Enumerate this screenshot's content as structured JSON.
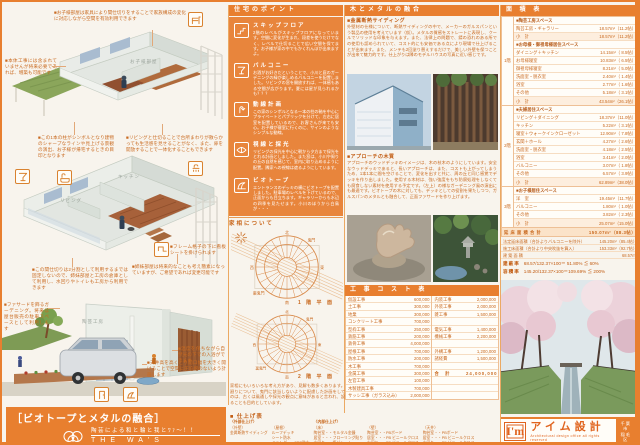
{
  "colors": {
    "accent": "#e87f2f",
    "accent_deep": "#c25c12",
    "panel_orange": "#e8853c",
    "text_orange": "#c96a20"
  },
  "left": {
    "labels": {
      "r1_room": "お子様部屋",
      "r2_living": "リビング",
      "r2_kitchen": "キッチン",
      "r3_studio": "陶芸工房"
    },
    "annotations": [
      "■お子様部屋は家具により間仕切りをすることで家族構成の変化に対応しながら空間を有効利用できます",
      "■本体工事には含まれていませんが将来必要であれば、増築も可能です",
      "■この1本の柱がシンボルとなり建物のシャープなラインや見上げる景観の演出、お子様が帰宅するときの目印となります",
      "■リビングと仕切ることで台所まわりが散らかっても生活感を見せることがなく、また、扉を開放することで一体化することもできます",
      "■フレーム格子の下に看板シートを掛けられます",
      "■この間仕切りは2分割として利用するまでは固定しないので、姉妹部屋と工房の倉庫として利用し、水回りやトイレも工房から利用できます",
      "■姉妹部屋は将来的なことも考え簡素になっていますが、ご希望であれば変更可能です",
      "■ファサードを飾るガーデニング。将来は屋台販売の駐車スペースとして利用します",
      "■温度を保ちながら自然光の下での入浴ができます",
      "■天井高を高くとり開口幅を大きく開けることで空間に圧迫感のないよう計画します"
    ],
    "banner": {
      "title": "［ビオトープとメタルの融合］",
      "tagline": "陶芸による和と輪と我とﾜｧ～！！",
      "subtitle": "THE WA'S HOUSE"
    }
  },
  "points": {
    "header": "住宅のポイント",
    "sections": [
      {
        "icon": "skip-floor-icon",
        "title": "スキップフロア",
        "body": "2階のレベルがスキップフロアになっています。空間に変化が生まれ、段差を使うだけでなく、レベルで仕切ることで広い空間を保てます。お子様が家の中でもかくれんぼが出来ますよ。"
      },
      {
        "icon": "cocktail-icon",
        "title": "バルコニー",
        "body": "お酒がお好きだということで、小川と庭のガーデニングの緑が楽しめるバルコニーを配置しました。リビングの窓を開放すれば、一体感もある空間が広がります。夏には星が見られるかも？？？"
      },
      {
        "icon": "flow-line-icon",
        "title": "動線計画",
        "body": "この家のシンボルとなる一本の柱の軸を中心にプライベートとパブリックを分けて、左右に居室を配置しているので、お客さんが来ても安心。お子様が寝室に行くのに、サインのようなシンプルな動線。"
      },
      {
        "icon": "daylight-icon",
        "title": "視線と採光",
        "body": "リビングの採光を中心に朝から夕方まで採光をとれる計画としました。また窓は、小川や周りの丘の自然を感じて、室内に取り込めるように配置。隣家への視線は遮るようにしています。"
      },
      {
        "icon": "biotope-icon",
        "title": "ビオトープ",
        "body": "エントランスのデッキの横にビオトープを配置しました。駐車場のレベルを下げているので、正面からも目立ちます。ギャラリーからも水辺の四季を見たせます。小川のほうから白鳥が・・・"
      }
    ]
  },
  "kasou": {
    "header": "家相について",
    "chart1_label": "1 階 平 面",
    "chart2_label": "2 階 平 面",
    "directions": [
      "北",
      "東",
      "南",
      "西",
      "鬼門",
      "裏鬼門"
    ],
    "paragraph": "家相にもいろいろな考え方があり、見解も数多くあります。今回は母屋・水回り・火廻りについて、鬼門に該当しないように配慮した計画をしています。この家相というのは、古くは風通しや採光の観点に意味があると言われ、設計に際し現代水準に達することも目的としています。"
  },
  "finish": {
    "title": "■ 仕上げ表",
    "groups": [
      {
        "header": "〈外部仕上げ〉",
        "part": "（外壁）",
        "items": [
          "金属断熱サイディング"
        ]
      },
      {
        "header": "",
        "part": "（屋根）",
        "items": [
          "ルーフデッキ",
          "シート防水",
          "ベランダ・・FRP防水"
        ]
      },
      {
        "header": "〈内部仕上げ〉",
        "part": "（床）",
        "items": [
          "陶芸室・・モルタル金鏝",
          "居室・・・フローリング貼り",
          "水回り・・塩ビシート"
        ]
      },
      {
        "header": "",
        "part": "（壁）",
        "items": [
          "陶芸室・・PBボード",
          "居室・・・PB ビニールクロス",
          "水回り・・PB ビニールクロス"
        ]
      },
      {
        "header": "",
        "part": "（天井）",
        "items": [
          "陶芸室・・PBボード",
          "居室・・・PB ビニールクロス",
          "水回り・・PB ビニールクロス"
        ]
      }
    ]
  },
  "metal": {
    "header": "木とメタルの融合",
    "sections": [
      {
        "title": "■金属断熱サイディング",
        "body": "外壁材の仕様について、断熱サイディングの中で、メーカーのガルスパンという製品の使用を考えています（仮）。メタルの質感をストレートに表現し、クールでソリッドな印象を与えます。また、法律上の問題で、錆の恐れのある所での使用も認められていて、コスト的にも安価である点により現場で仕上げることが出来ます。また、メンテも2回塗り替えするだけで、美しい外壁を保つことが出来て魅力的です。仕上がりは隣のモデルハウスの写真に近い感じです。"
      },
      {
        "title": "■アプローチの木質",
        "body": "アプローチのウッドデッキのイメージは、木の枝木のようにしています。安全なウッドデッキであると、長いアプローチは、また、コストも上がってしまうため、1本1本に間を空けることで、変化を出すと共に、周の丘と同じ感覚でデッキを作り出しました。使用する木材は、強い強度をもち防腐処理をしなくても腐食しない素材を使用する予定です。（左上）の様なガーデニング風の演出にも最適です。ビオトープの木に対しても、デッキとしての役割を果たしつつ、ガルスパンのメタルとも融合して、正面ファサードを作り上げます。"
      }
    ]
  },
  "cost": {
    "header": "工 事 コ ス ト 表",
    "left_rows": [
      [
        "仮設工事",
        "600,000"
      ],
      [
        "土工事",
        "300,000"
      ],
      [
        "地業",
        "300,000"
      ],
      [
        "コンクリート工事",
        "700,000"
      ],
      [
        "型枠工事",
        "250,000"
      ],
      [
        "鉄筋工事",
        "200,000"
      ],
      [
        "鉄骨工事",
        "4,000,000"
      ],
      [
        "屋根工事",
        "700,000"
      ],
      [
        "防水工事",
        "200,000"
      ],
      [
        "木工事",
        "700,000"
      ],
      [
        "金属工事",
        "300,000"
      ],
      [
        "左官工事",
        "100,000"
      ],
      [
        "木製建具工事",
        "700,000"
      ],
      [
        "サッシ工事（ガラス込み）",
        "2,000,000"
      ]
    ],
    "right_rows": [
      [
        "内装工事",
        "2,000,000"
      ],
      [
        "外装工事",
        "2,000,000"
      ],
      [
        "雑工事",
        "1,500,000"
      ],
      [
        "",
        ""
      ],
      [
        "電気工事",
        "1,400,000"
      ],
      [
        "機械工事",
        "2,200,000"
      ],
      [
        "",
        ""
      ],
      [
        "外構工事",
        "1,200,000"
      ],
      [
        "諸経費",
        "1,500,000"
      ],
      [
        "",
        ""
      ],
      [
        "合　計",
        "24,000,000"
      ],
      [
        "",
        ""
      ],
      [
        "",
        ""
      ],
      [
        "",
        ""
      ]
    ]
  },
  "area": {
    "header": "面 積 表",
    "floors": [
      {
        "label": "1階",
        "rows": [
          {
            "t": "g",
            "label": "■陶芸工房スペース",
            "value": ""
          },
          {
            "t": "i",
            "label": "陶芸工房・ギャラリー",
            "value": "18.57m²（11.2帖）"
          },
          {
            "t": "s",
            "label": "小　計",
            "value": "18.57m²（11.2帖）"
          },
          {
            "t": "g",
            "label": "■お母様・御祖母様居住スペース",
            "value": ""
          },
          {
            "t": "i",
            "label": "ダイニング＋キッチン",
            "value": "14.15m²（ 8.5帖）"
          },
          {
            "t": "i",
            "label": "お母様寝室",
            "value": "10.83m²（ 6.5帖）"
          },
          {
            "t": "i",
            "label": "御祖母様寝室",
            "value": "8.21m²（ 5.0帖）"
          },
          {
            "t": "i",
            "label": "洗面室・脱衣室",
            "value": "2.40m²（ 1.4帖）"
          },
          {
            "t": "i",
            "label": "浴室",
            "value": "2.77m²（ 1.6帖）"
          },
          {
            "t": "i",
            "label": "その他",
            "value": "5.18m²（ 3.1帖）"
          },
          {
            "t": "s",
            "label": "小　計",
            "value": "43.54m²（26.1帖）"
          }
        ]
      },
      {
        "label": "2階",
        "rows": [
          {
            "t": "g",
            "label": "■夫婦居住スペース",
            "value": ""
          },
          {
            "t": "i",
            "label": "リビング＋ダイニング",
            "value": "18.37m²（11.0帖）"
          },
          {
            "t": "i",
            "label": "キッチン",
            "value": "5.22m²（ 3.1帖）"
          },
          {
            "t": "i",
            "label": "寝室＋ウォークインクローゼット",
            "value": "12.90m²（ 7.8帖）"
          },
          {
            "t": "i",
            "label": "玄関＋ホール",
            "value": "4.27m²（ 2.6帖）"
          },
          {
            "t": "i",
            "label": "洗面室・脱衣室",
            "value": "4.18m²（ 2.5帖）"
          },
          {
            "t": "i",
            "label": "浴室",
            "value": "3.41m²（ 2.0帖）"
          },
          {
            "t": "i",
            "label": "バルコニー",
            "value": "3.07m²（ 1.8帖）"
          },
          {
            "t": "i",
            "label": "その他",
            "value": "6.57m²（ 3.9帖）"
          },
          {
            "t": "s",
            "label": "小　計",
            "value": "62.89m²（38.0帖）"
          }
        ]
      },
      {
        "label": "3階",
        "rows": [
          {
            "t": "g",
            "label": "■お子様居住スペース",
            "value": ""
          },
          {
            "t": "i",
            "label": "洋　室",
            "value": "19.45m²（11.7帖）"
          },
          {
            "t": "i",
            "label": "バルコニー",
            "value": "1.80m²（ 1.0帖）"
          },
          {
            "t": "i",
            "label": "その他",
            "value": "3.82m²（ 2.3帖）"
          },
          {
            "t": "s",
            "label": "小　計",
            "value": "25.07m²（15.0帖）"
          }
        ]
      }
    ],
    "total": {
      "label": "延 床 面 積 合 計",
      "value": "150.07m²（88.3帖）"
    },
    "summary": [
      {
        "label": "法定延床面積（合計よりバルコニーを除外）",
        "value": "145.20m²（85.4帖）"
      },
      {
        "label": "施工床面積（合計より中央吹抜を算入）",
        "value": "153.33m²（92.7帖）"
      },
      {
        "label": "建 築 面 積",
        "value": "68.57m²"
      }
    ],
    "ratios": [
      {
        "label": "建蔽率",
        "value": "68.57/132.37×100＝ 51.80% ≦ 60%"
      },
      {
        "label": "容積率",
        "value": "145.20/132.37×100＝109.69% ≦ 200%"
      }
    ]
  },
  "logo": {
    "mark": "I'm",
    "name": "アイム設計",
    "tagline": "Architectural design office all rights reserved",
    "location": [
      "千葉市",
      "稲毛区"
    ]
  }
}
